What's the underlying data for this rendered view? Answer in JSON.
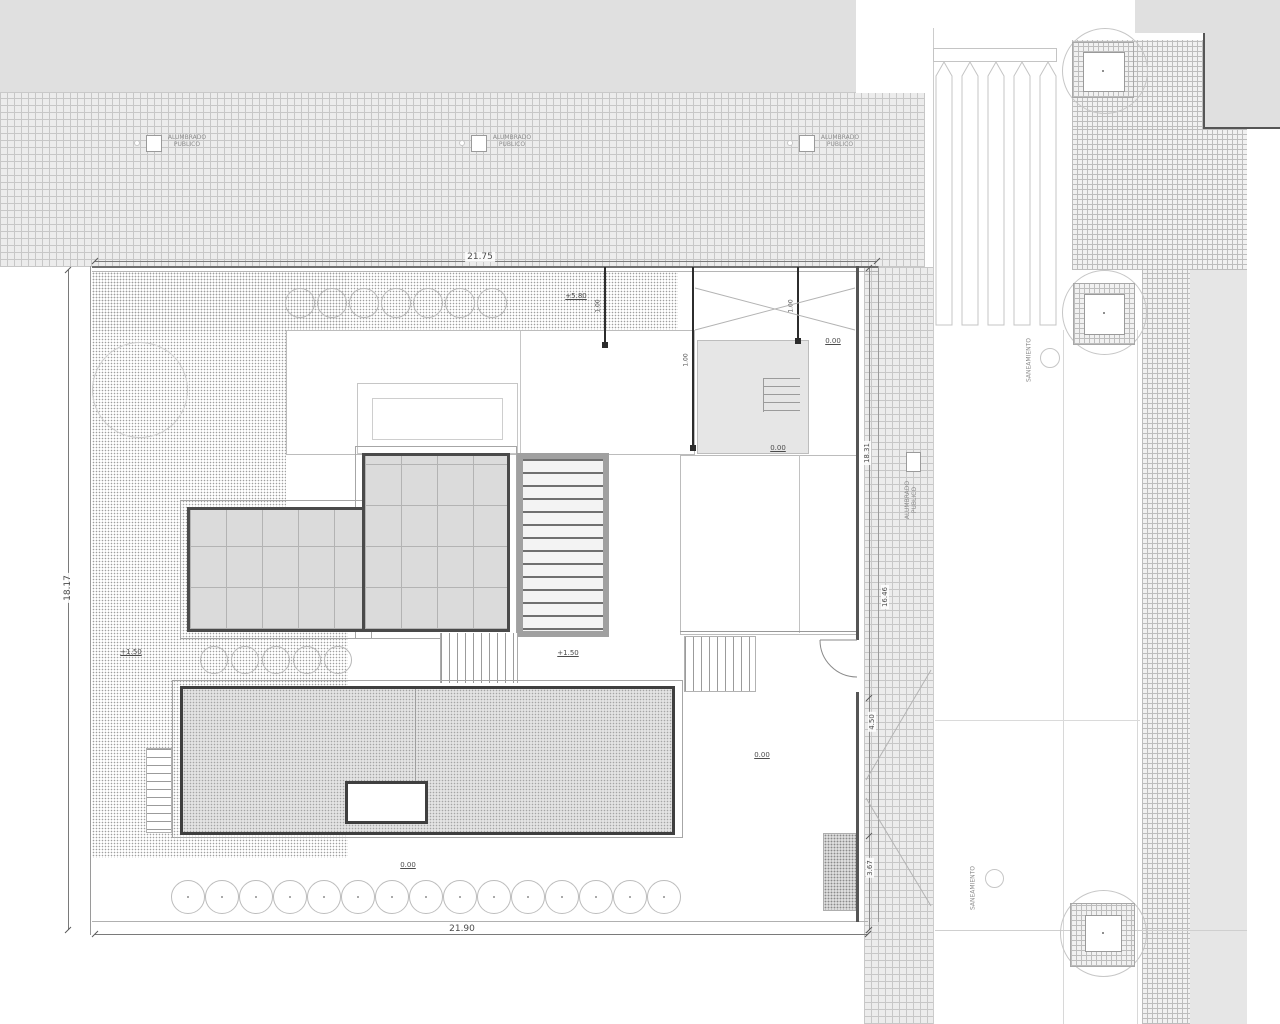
{
  "drawing": {
    "type": "architectural-roof-site-plan",
    "colors": {
      "paving_gray": "#e0e0e0",
      "hatch_line": "#c7c7c7",
      "wall_dark": "#4a4a4a",
      "glass_roof_gray": "#dbdbdb",
      "text": "#4c4c4c"
    }
  },
  "street": {
    "lamp_label": "ALUMBRADO\nPUBLICO",
    "lamp_label_vertical": "ALUMBRADO\nPUBLICO",
    "manhole_label_top": "SANEAMIENTO",
    "manhole_label_bottom": "SANEAMIENTO"
  },
  "dimensions": {
    "top": "21.75",
    "bottom": "21.90",
    "left": "18.17",
    "right_upper": "18.31",
    "right_mid": "16.46",
    "right_lower": "4.50",
    "right_bottom": "3.67",
    "offset": "1.00"
  },
  "levels": {
    "roof": "+5.80",
    "terrace_left": "+1.50",
    "terrace_center": "+1.50",
    "patio_right_a": "0.00",
    "patio_right_b": "0.00",
    "entry_court": "0.00",
    "front_walk": "0.00"
  }
}
